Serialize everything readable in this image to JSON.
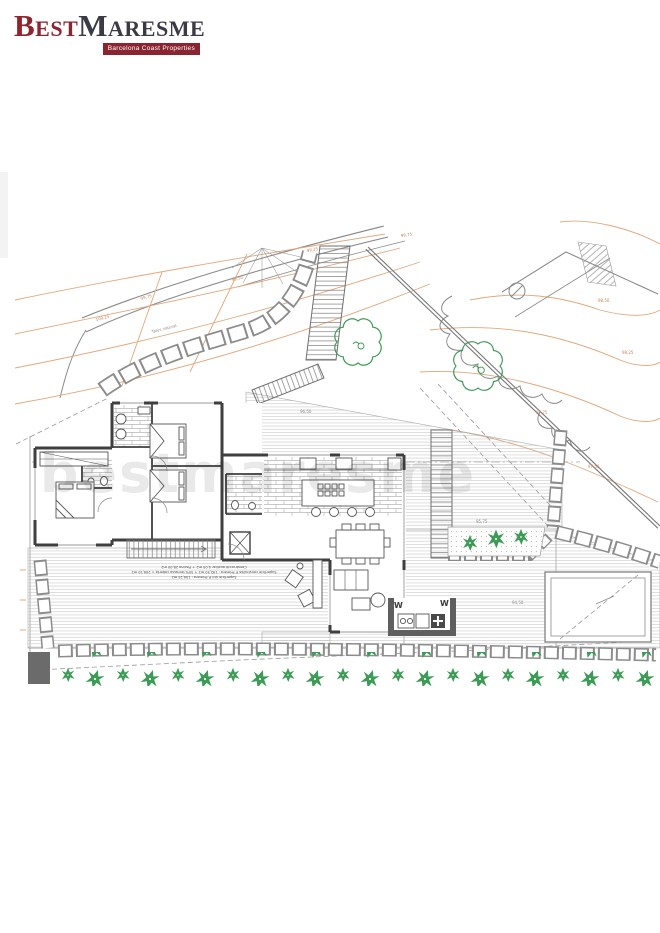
{
  "brand": {
    "word1": "Best",
    "word2": "Maresme",
    "tagline": "Barcelona Coast Properties",
    "accent_color": "#8a2430"
  },
  "watermark": "bestmaresme",
  "plan": {
    "slope_label": "Talús natural",
    "w_label_left": "W",
    "w_label_right": "W",
    "elevation_labels": [
      "100,25",
      "99,75",
      "99,50",
      "99,25",
      "98,75",
      "98,50",
      "98,25",
      "97,75",
      "97,50",
      "96,50",
      "95,75",
      "94,50"
    ],
    "annotation": {
      "line1": "Superfície útil P. Primera : 156,25 m2",
      "line2": "Superfície construïda P. Primera : 192,50 m2 + 50% terrassa coberta = 206,10 m2",
      "line3": "Construcció auxiliar 4,05 m2 + Piscina 28,00 m2"
    },
    "colors": {
      "contour": "#e2a87e",
      "terrain": "#8a8a8a",
      "wall": "#3f3f3f",
      "vegetation": "#3d9b57",
      "stone_outline": "#8c8c8c"
    }
  }
}
